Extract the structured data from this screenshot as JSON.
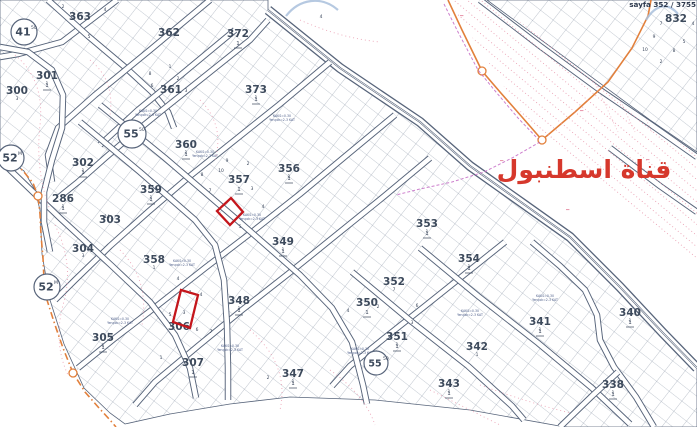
{
  "header": {
    "sheet_label": "sayfa 352 / 3755"
  },
  "map": {
    "canal_label": {
      "text": "قناة اسطنبول",
      "x": 584,
      "y": 178,
      "size": 25,
      "color": "#d6382c"
    },
    "colors": {
      "line_dark": "#57647a",
      "hatch_line": "#6b7a8e",
      "contour_pink": "#e790a6",
      "boundary_orange": "#e2803c",
      "cadastral_magenta": "#c468c4",
      "highlight_red": "#c4161c",
      "canal_text_red": "#d6382c",
      "blue_stroke": "#a9c0dc"
    },
    "blocks": [
      {
        "n": "363",
        "x": 80,
        "y": 16,
        "sub": false
      },
      {
        "n": "362",
        "x": 169,
        "y": 32,
        "sub": false
      },
      {
        "n": "372",
        "x": 238,
        "y": 33,
        "sub": true
      },
      {
        "n": "301",
        "x": 47,
        "y": 75,
        "sub": true
      },
      {
        "n": "300",
        "x": 17,
        "y": 90,
        "sub": false
      },
      {
        "n": "361",
        "x": 171,
        "y": 89,
        "sub": false
      },
      {
        "n": "373",
        "x": 256,
        "y": 89,
        "sub": true
      },
      {
        "n": "360",
        "x": 186,
        "y": 144,
        "sub": true
      },
      {
        "n": "302",
        "x": 83,
        "y": 162,
        "sub": true
      },
      {
        "n": "356",
        "x": 289,
        "y": 168,
        "sub": true
      },
      {
        "n": "357",
        "x": 239,
        "y": 179,
        "sub": true
      },
      {
        "n": "359",
        "x": 151,
        "y": 189,
        "sub": true
      },
      {
        "n": "286",
        "x": 63,
        "y": 198,
        "sub": true
      },
      {
        "n": "303",
        "x": 110,
        "y": 219,
        "sub": false
      },
      {
        "n": "349",
        "x": 283,
        "y": 241,
        "sub": true
      },
      {
        "n": "304",
        "x": 83,
        "y": 248,
        "sub": false
      },
      {
        "n": "358",
        "x": 154,
        "y": 259,
        "sub": false
      },
      {
        "n": "348",
        "x": 239,
        "y": 300,
        "sub": true
      },
      {
        "n": "305",
        "x": 103,
        "y": 337,
        "sub": true
      },
      {
        "n": "306",
        "x": 179,
        "y": 326,
        "sub": false
      },
      {
        "n": "307",
        "x": 193,
        "y": 362,
        "sub": true
      },
      {
        "n": "353",
        "x": 427,
        "y": 223,
        "sub": true
      },
      {
        "n": "354",
        "x": 469,
        "y": 258,
        "sub": true
      },
      {
        "n": "352",
        "x": 394,
        "y": 281,
        "sub": false
      },
      {
        "n": "350",
        "x": 367,
        "y": 302,
        "sub": true
      },
      {
        "n": "351",
        "x": 397,
        "y": 336,
        "sub": true
      },
      {
        "n": "347",
        "x": 293,
        "y": 373,
        "sub": true
      },
      {
        "n": "341",
        "x": 540,
        "y": 321,
        "sub": true
      },
      {
        "n": "342",
        "x": 477,
        "y": 346,
        "sub": false
      },
      {
        "n": "343",
        "x": 449,
        "y": 383,
        "sub": true
      },
      {
        "n": "340",
        "x": 630,
        "y": 312,
        "sub": true
      },
      {
        "n": "338",
        "x": 613,
        "y": 384,
        "sub": true
      },
      {
        "n": "832",
        "x": 676,
        "y": 18,
        "sub": false
      }
    ],
    "junction_markers": [
      {
        "label": "41",
        "sup": "50",
        "x": 24,
        "y": 32,
        "r": 13
      },
      {
        "label": "55",
        "sup": "50",
        "x": 132,
        "y": 134,
        "r": 14
      },
      {
        "label": "52",
        "sup": "M",
        "x": 11,
        "y": 158,
        "r": 13
      },
      {
        "label": "52",
        "sup": "M",
        "x": 47,
        "y": 287,
        "r": 13
      },
      {
        "label": "55",
        "sup": "50",
        "x": 376,
        "y": 363,
        "r": 12
      }
    ],
    "parcel_numbers": [
      [
        661,
        25,
        "7"
      ],
      [
        693,
        25,
        "4"
      ],
      [
        654,
        38,
        "9"
      ],
      [
        684,
        43,
        "5"
      ],
      [
        645,
        51,
        "10"
      ],
      [
        674,
        52,
        "8"
      ],
      [
        661,
        63,
        "2"
      ],
      [
        105,
        11,
        "4"
      ],
      [
        89,
        38,
        "5"
      ],
      [
        63,
        8,
        "2"
      ],
      [
        170,
        68,
        "1"
      ],
      [
        178,
        80,
        "2"
      ],
      [
        186,
        92,
        "3"
      ],
      [
        150,
        75,
        "8"
      ],
      [
        152,
        87,
        "6"
      ],
      [
        321,
        18,
        "4"
      ],
      [
        256,
        99,
        "1"
      ],
      [
        227,
        162,
        "9"
      ],
      [
        221,
        172,
        "10"
      ],
      [
        248,
        165,
        "2"
      ],
      [
        263,
        208,
        "4"
      ],
      [
        252,
        190,
        "3"
      ],
      [
        210,
        192,
        "7"
      ],
      [
        202,
        176,
        "8"
      ],
      [
        240,
        228,
        "5"
      ],
      [
        289,
        178,
        "1"
      ],
      [
        186,
        154,
        "1"
      ],
      [
        151,
        199,
        "1"
      ],
      [
        47,
        85,
        "1"
      ],
      [
        17,
        100,
        "3"
      ],
      [
        83,
        172,
        "1"
      ],
      [
        63,
        208,
        "1"
      ],
      [
        107,
        218,
        "14"
      ],
      [
        83,
        257,
        "3"
      ],
      [
        103,
        347,
        "1"
      ],
      [
        154,
        269,
        "1"
      ],
      [
        178,
        280,
        "4"
      ],
      [
        190,
        294,
        "7"
      ],
      [
        201,
        296,
        "4"
      ],
      [
        170,
        316,
        "5"
      ],
      [
        184,
        314,
        "3"
      ],
      [
        197,
        331,
        "6"
      ],
      [
        211,
        333,
        "7"
      ],
      [
        161,
        359,
        "1"
      ],
      [
        239,
        310,
        "1"
      ],
      [
        283,
        251,
        "1"
      ],
      [
        293,
        383,
        "1"
      ],
      [
        268,
        379,
        "2"
      ],
      [
        378,
        308,
        "2"
      ],
      [
        348,
        312,
        "4"
      ],
      [
        417,
        307,
        "6"
      ],
      [
        412,
        324,
        "3"
      ],
      [
        394,
        291,
        "7"
      ],
      [
        427,
        233,
        "1"
      ],
      [
        469,
        268,
        "1"
      ],
      [
        397,
        346,
        "1"
      ],
      [
        540,
        331,
        "1"
      ],
      [
        630,
        322,
        "1"
      ],
      [
        613,
        394,
        "1"
      ],
      [
        449,
        393,
        "1"
      ],
      [
        477,
        356,
        "1"
      ]
    ],
    "annotations": {
      "line1": "KAKS=0.30",
      "line2": "Yençok=2-3 KAT",
      "positions": [
        [
          148,
          112
        ],
        [
          205,
          153
        ],
        [
          282,
          117
        ],
        [
          252,
          216
        ],
        [
          182,
          262
        ],
        [
          120,
          320
        ],
        [
          230,
          347
        ],
        [
          360,
          350
        ],
        [
          470,
          312
        ],
        [
          545,
          297
        ]
      ]
    },
    "highlighted_parcels": [
      {
        "name": "highlighted-parcel-357",
        "points": [
          [
            231,
            198
          ],
          [
            243,
            212
          ],
          [
            230,
            225
          ],
          [
            217,
            211
          ]
        ]
      },
      {
        "name": "highlighted-parcel-306",
        "points": [
          [
            181,
            290
          ],
          [
            198,
            295
          ],
          [
            190,
            328
          ],
          [
            173,
            322
          ]
        ]
      }
    ]
  }
}
